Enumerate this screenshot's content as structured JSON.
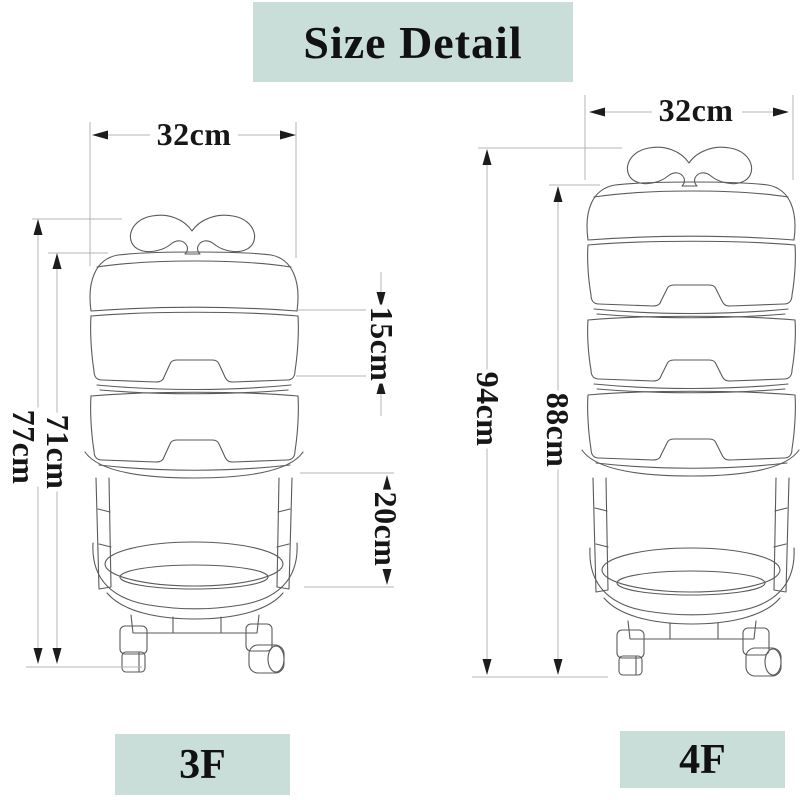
{
  "title": "Size Detail",
  "carts": [
    {
      "floor_label": "3F",
      "dims": {
        "width": "32cm",
        "total_height": "77cm",
        "body_height": "71cm",
        "tier_height": "15cm",
        "basket_height": "20cm"
      }
    },
    {
      "floor_label": "4F",
      "dims": {
        "width": "32cm",
        "total_height": "94cm",
        "body_height": "88cm"
      }
    }
  ],
  "colors": {
    "label_bg": "#c9ddd9",
    "drawing_line": "#5a5a5a",
    "dimension_line": "#b4b4b4",
    "text": "#161616",
    "page_bg": "#ffffff"
  }
}
